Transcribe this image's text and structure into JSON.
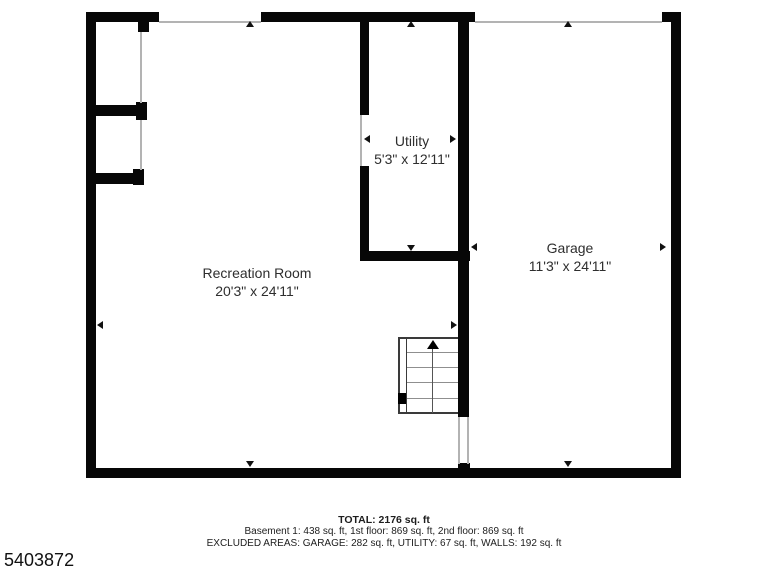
{
  "floorplan": {
    "rooms": {
      "recreation": {
        "label": "Recreation Room",
        "dims": "20'3\" x 24'11\""
      },
      "utility": {
        "label": "Utility",
        "dims": "5'3\" x 12'11\""
      },
      "garage": {
        "label": "Garage",
        "dims": "11'3\" x 24'11\""
      }
    },
    "stairs_direction": "up",
    "colors": {
      "wall": "#070707",
      "opening_line": "#b3b3b3",
      "text": "#2e2e2e",
      "background": "#ffffff"
    },
    "icons": {
      "dimension_markers": [
        "arrow-up",
        "arrow-down",
        "arrow-left",
        "arrow-right"
      ],
      "stairs_arrow": "arrow-up"
    }
  },
  "summary": {
    "total": "TOTAL: 2176 sq. ft",
    "floors": "Basement 1: 438 sq. ft, 1st floor: 869 sq. ft, 2nd floor: 869 sq. ft",
    "excluded": "EXCLUDED AREAS: GARAGE: 282 sq. ft, UTILITY: 67 sq. ft, WALLS: 192 sq. ft"
  },
  "plan_id": "5403872"
}
